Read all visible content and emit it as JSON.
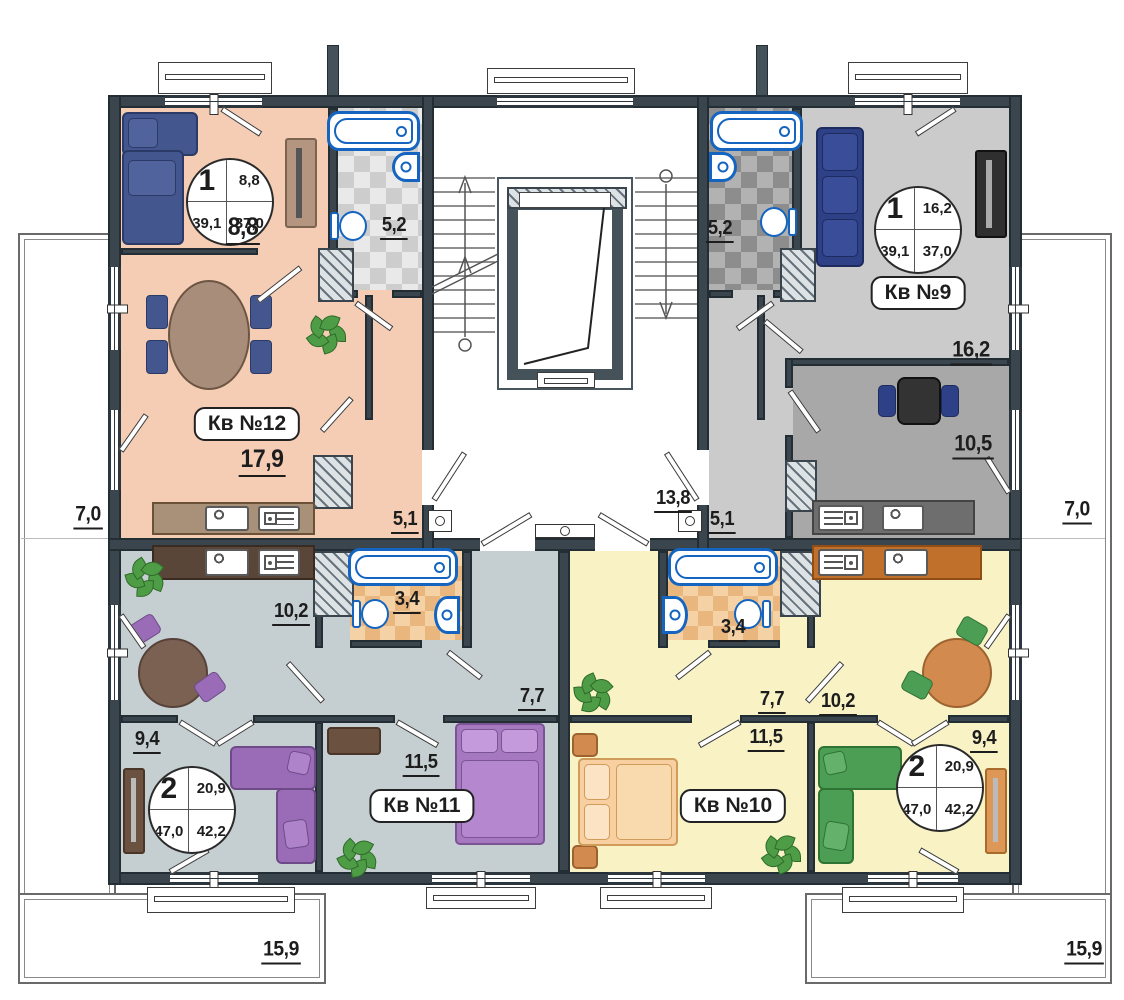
{
  "terraces": {
    "left": "7,0",
    "right": "7,0",
    "bottom_left": "15,9",
    "bottom_right": "15,9"
  },
  "stairwell": {
    "landing_area": "13,8"
  },
  "apartments": {
    "kv12": {
      "name": "Кв №12",
      "info": {
        "rooms": "1",
        "living_area": "8,8",
        "total_area": "39,1",
        "reduced_area": "37,0"
      },
      "areas": {
        "living": "8,8",
        "bathroom": "5,2",
        "kitchen_living": "17,9",
        "hall": "5,1"
      }
    },
    "kv9": {
      "name": "Кв №9",
      "info": {
        "rooms": "1",
        "living_area": "16,2",
        "total_area": "39,1",
        "reduced_area": "37,0"
      },
      "areas": {
        "living": "16,2",
        "bathroom": "5,2",
        "kitchen": "10,5",
        "hall": "5,1"
      }
    },
    "kv11": {
      "name": "Кв №11",
      "info": {
        "rooms": "2",
        "living_area": "20,9",
        "total_area": "47,0",
        "reduced_area": "42,2"
      },
      "areas": {
        "kitchen_living": "10,2",
        "bathroom": "3,4",
        "hall": "7,7",
        "bedroom": "11,5",
        "bedroom2": "9,4"
      }
    },
    "kv10": {
      "name": "Кв №10",
      "info": {
        "rooms": "2",
        "living_area": "20,9",
        "total_area": "47,0",
        "reduced_area": "42,2"
      },
      "areas": {
        "kitchen_living": "10,2",
        "bathroom": "3,4",
        "hall": "7,7",
        "bedroom": "11,5",
        "bedroom2": "9,4"
      }
    }
  },
  "colors": {
    "wall": "#3a454d",
    "kv12_floor": "#f4cdb4",
    "kv9_floor": "#cbcbcb",
    "kv9_kitchen_floor": "#a8a8a8",
    "kv11_floor": "#c5cfd1",
    "kv10_floor": "#f8f2c5",
    "fixture_outline": "#1565c0",
    "sofa_blue": "#44568e",
    "sofa_navy": "#2e4086",
    "accent_purple": "#9a6cb8",
    "accent_green": "#4d9e55",
    "accent_orange": "#d28a4e"
  }
}
